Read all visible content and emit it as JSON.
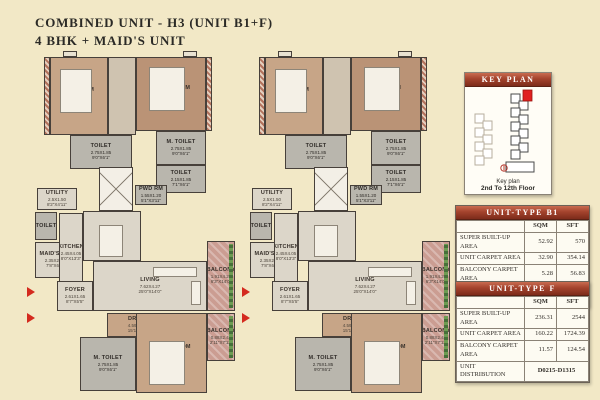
{
  "title": {
    "line1": "COMBINED UNIT - H3 (UNIT B1+F)",
    "line2": "4 BHK + MAID'S UNIT"
  },
  "key_plan": {
    "header": "KEY PLAN",
    "caption_label": "Key plan",
    "caption_floors": "2nd To 12th Floor"
  },
  "tables": [
    {
      "title": "UNIT-TYPE B1",
      "col_sqm": "SQM",
      "col_sft": "SFT",
      "rows": [
        {
          "label": "SUPER BUILT-UP AREA",
          "sqm": "52.92",
          "sft": "570"
        },
        {
          "label": "UNIT CARPET AREA",
          "sqm": "32.90",
          "sft": "354.14"
        },
        {
          "label": "BALCONY CARPET AREA",
          "sqm": "5.28",
          "sft": "56.83"
        }
      ],
      "distribution_label": "UNIT DISTRIBUTION",
      "distribution_value": "D0216-D1316"
    },
    {
      "title": "UNIT-TYPE F",
      "col_sqm": "SQM",
      "col_sft": "SFT",
      "rows": [
        {
          "label": "SUPER BUILT-UP AREA",
          "sqm": "236.31",
          "sft": "2544"
        },
        {
          "label": "UNIT CARPET AREA",
          "sqm": "160.22",
          "sft": "1724.39"
        },
        {
          "label": "BALCONY CARPET AREA",
          "sqm": "11.57",
          "sft": "124.54"
        }
      ],
      "distribution_label": "UNIT DISTRIBUTION",
      "distribution_value": "D0215-D1315"
    }
  ],
  "plans": {
    "left": {
      "rooms": [
        {
          "name": "BEDROOM",
          "dim_m": "3.65X3.05",
          "dim_ft": "12'0\"X10'0\""
        },
        {
          "name": "M. BEDROOM",
          "dim_m": "4.25X3.95",
          "dim_ft": "13'11\"X13'0\""
        },
        {
          "name": "TOILET",
          "dim_m": "2.75X1.85",
          "dim_ft": "9'0\"X6'1\""
        },
        {
          "name": "M. TOILET",
          "dim_m": "2.75X1.85",
          "dim_ft": "9'0\"X6'1\""
        },
        {
          "name": "TOILET",
          "dim_m": "2.15X1.85",
          "dim_ft": "7'1\"X6'1\""
        },
        {
          "name": "UTILITY",
          "dim_m": "2.5X1.50",
          "dim_ft": "8'2\"X4'11\""
        },
        {
          "name": "TOILET",
          "dim_m": "",
          "dim_ft": ""
        },
        {
          "name": "MAID'S RM",
          "dim_m": "2.35X2.04",
          "dim_ft": "7'8\"X6'8\""
        },
        {
          "name": "KITCHEN",
          "dim_m": "2.45X4.05",
          "dim_ft": "8'0\"X13'3\""
        },
        {
          "name": "PWD RM",
          "dim_m": "1.55X1.20",
          "dim_ft": "5'1\"X3'11\""
        },
        {
          "name": "DINING",
          "dim_m": "4.55X2.35",
          "dim_ft": "14'11\"X7'8\""
        },
        {
          "name": "FOYER",
          "dim_m": "2.61X1.65",
          "dim_ft": "8'7\"X5'5\""
        },
        {
          "name": "LIVING",
          "dim_m": "7.62X4.27",
          "dim_ft": "25'0\"X14'0\""
        },
        {
          "name": "BALCONY",
          "dim_m": "1.91X4.27",
          "dim_ft": "6'3\"X14'0\""
        },
        {
          "name": "DRESS",
          "dim_m": "4.59X1.52",
          "dim_ft": "15'1\"X5'0\""
        },
        {
          "name": "M. TOILET",
          "dim_m": "2.75X1.85",
          "dim_ft": "9'0\"X6'1\""
        },
        {
          "name": "M. BEDROOM",
          "dim_m": "5.25X4.20",
          "dim_ft": "17'3\"X13'9\""
        },
        {
          "name": "BALCONY",
          "dim_m": "0.88X2.41",
          "dim_ft": "2'11\"X7'11\""
        }
      ]
    },
    "right": {
      "rooms": [
        {
          "name": "BEDROOM",
          "dim_m": "3.65X3.05",
          "dim_ft": "12'0\"X10'0\""
        },
        {
          "name": "BEDROOM",
          "dim_m": "4.25X3.95",
          "dim_ft": "13'11\"X13'0\""
        },
        {
          "name": "TOILET",
          "dim_m": "2.75X1.85",
          "dim_ft": "9'0\"X6'1\""
        },
        {
          "name": "TOILET",
          "dim_m": "2.75X1.85",
          "dim_ft": "9'0\"X6'1\""
        },
        {
          "name": "TOILET",
          "dim_m": "2.15X1.85",
          "dim_ft": "7'1\"X6'1\""
        },
        {
          "name": "UTILITY",
          "dim_m": "2.5X1.50",
          "dim_ft": "8'2\"X4'11\""
        },
        {
          "name": "TOILET",
          "dim_m": "",
          "dim_ft": ""
        },
        {
          "name": "MAID'S RM",
          "dim_m": "2.35X2.04",
          "dim_ft": "7'8\"X6'8\""
        },
        {
          "name": "KITCHEN",
          "dim_m": "2.45X4.05",
          "dim_ft": "8'0\"X13'3\""
        },
        {
          "name": "PWD RM",
          "dim_m": "1.55X1.20",
          "dim_ft": "5'1\"X3'11\""
        },
        {
          "name": "DINING",
          "dim_m": "4.55X2.35",
          "dim_ft": "14'11\"X7'8\""
        },
        {
          "name": "FOYER",
          "dim_m": "2.61X1.65",
          "dim_ft": "8'7\"X5'5\""
        },
        {
          "name": "LIVING",
          "dim_m": "7.62X4.27",
          "dim_ft": "25'0\"X14'0\""
        },
        {
          "name": "BALCONY",
          "dim_m": "1.91X4.27",
          "dim_ft": "6'3\"X14'0\""
        },
        {
          "name": "DRESS",
          "dim_m": "4.59X1.52",
          "dim_ft": "15'1\"X5'0\""
        },
        {
          "name": "M. TOILET",
          "dim_m": "2.75X1.85",
          "dim_ft": "9'0\"X6'1\""
        },
        {
          "name": "M. BEDROOM",
          "dim_m": "5.25X4.20",
          "dim_ft": "17'3\"X13'9\""
        },
        {
          "name": "BALCONY",
          "dim_m": "0.88X2.41",
          "dim_ft": "2'11\"X7'11\""
        }
      ]
    }
  },
  "colors": {
    "background": "#f2e8c6",
    "table_header_top": "#c96b50",
    "table_header_bottom": "#7d2b1a",
    "highlight_unit_red": "#e02020",
    "wall": "#47403a",
    "wood_floor": "#c7a587",
    "balcony_pink": "#cb9d92"
  }
}
